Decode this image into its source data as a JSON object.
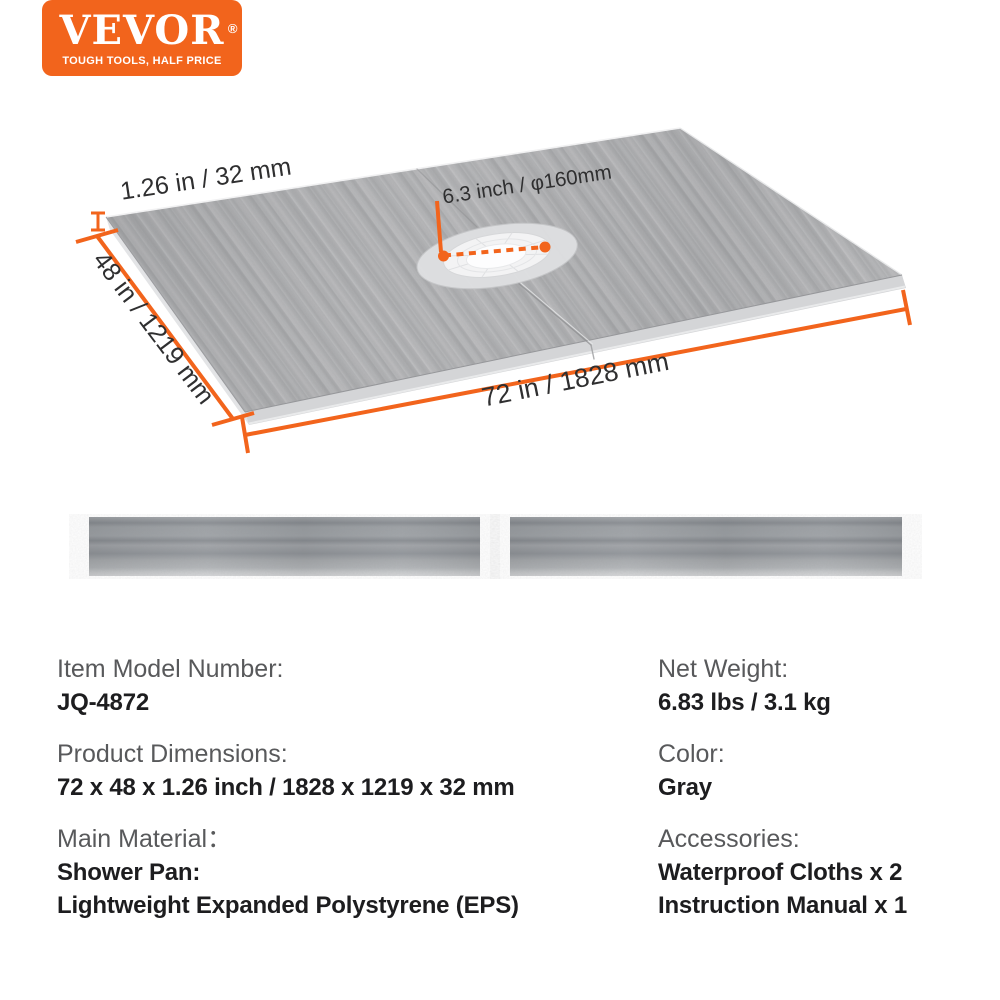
{
  "brand": {
    "name": "VEVOR",
    "registered_mark": "®",
    "tagline": "TOUGH TOOLS, HALF PRICE"
  },
  "colors": {
    "accent_orange": "#F2641C",
    "board_gray": "#B0B1B3",
    "board_side_gray": "#D5D6D8",
    "label_gray": "#58595B",
    "value_black": "#1D1D1F",
    "dimension_text": "#2F2F30"
  },
  "hero": {
    "thickness_label": "1.26 in / 32 mm",
    "drain_label": "6.3 inch / φ160mm",
    "width_label": "48 in / 1219 mm",
    "length_label": "72 in / 1828 mm"
  },
  "specs": {
    "left": [
      {
        "label": "Item Model Number:",
        "values": [
          "JQ-4872"
        ]
      },
      {
        "label": "Product Dimensions:",
        "values": [
          "72 x 48 x 1.26 inch / 1828 x 1219 x 32 mm"
        ]
      },
      {
        "label": "Main Material：",
        "values": [
          "Shower Pan:",
          "Lightweight Expanded Polystyrene (EPS)"
        ]
      }
    ],
    "right": [
      {
        "label": "Net Weight:",
        "values": [
          "6.83 lbs / 3.1 kg"
        ]
      },
      {
        "label": "Color:",
        "values": [
          "Gray"
        ]
      },
      {
        "label": "Accessories:",
        "values": [
          "Waterproof Cloths x 2",
          "Instruction Manual x 1"
        ]
      }
    ]
  }
}
